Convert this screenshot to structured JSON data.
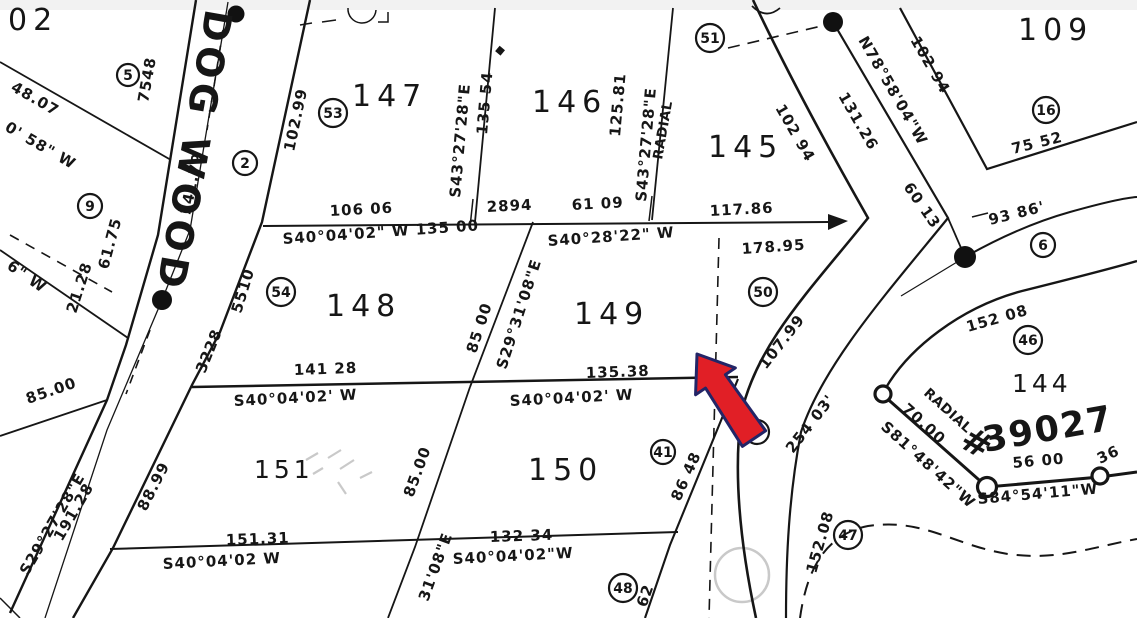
{
  "street": {
    "name": "DOG WOOD"
  },
  "lots": {
    "n147": "147",
    "n146": "146",
    "n145": "145",
    "n109": "109",
    "n148": "148",
    "n149": "149",
    "n150": "150",
    "n151": "151",
    "n144": "144",
    "fragment_top_left": "02",
    "parcel_number": "39027",
    "hash_mark": "#"
  },
  "points": {
    "a": "5",
    "b": "2",
    "c": "53",
    "d": "9",
    "e": "54",
    "f": "51",
    "g": "50",
    "h": "16",
    "i": "6",
    "j": "46",
    "k": "5",
    "l": "41",
    "m": "47",
    "n": "48"
  },
  "dims": {
    "d48_07": "48.07",
    "d0_58w": "0' 58\" W",
    "d7548": "7548",
    "d102_99": "102.99",
    "d141_79": "141.79",
    "d61_75": "61.75",
    "d21_28": "21.28",
    "d6w": "6\" W",
    "d5510": "5510",
    "d3228": "3228",
    "d88_99": "88.99",
    "d85_left": "85.00",
    "s29_27": "S29°27'28\"E",
    "d191_28": "191.28",
    "s43_a": "S43°27'28\"E",
    "d135_54": "135 54",
    "d125_81": "125.81",
    "s43_b": "S43°27'28\"E",
    "radial_a": "RADIAL",
    "d106_06": "106 06",
    "s40_main": "S40°04'02\" W  135 00",
    "d2894": "2894",
    "d61_09": "61 09",
    "d117_86": "117.86",
    "s40_28": "S40°28'22\" W",
    "d178_95": "178.95",
    "n78": "N78°58'04\"W",
    "d131_26": "131.26",
    "d102_94a": "102 94",
    "d102_94b": "102 94",
    "d60_13": "60 13",
    "d93_86": "93 86'",
    "d75_52": "75 52",
    "d141_28": "141 28",
    "s40_b": "S40°04'02' W",
    "d135_38": "135.38",
    "s40_c": "S40°04'02' W",
    "d151_31": "151.31",
    "s40_d": "S40°04'02  W",
    "d132_34": "132 34",
    "s40_e": "S40°04'02\"W",
    "d85_ab": "85 00",
    "s29_31": "S29°31'08\"E",
    "d85_cd": "85.00",
    "frag_31_08": "31'08\"E",
    "d86_48": "86 48",
    "d62": "62",
    "d107_99": "107.99",
    "d254_03": "254 03'",
    "d152_08a": "152 08",
    "d152_08b": "152.08",
    "radial_b": "RADIAL",
    "d70_00": "70.00",
    "s81": "S81°48'42\"W",
    "d56_00": "56 00",
    "s84": "S84°54'11\"W",
    "d36": "36",
    "frag_bottom": "40"
  },
  "colors": {
    "arrow_fill": "#e11f26",
    "arrow_outline": "#232567",
    "ink": "#161616"
  }
}
